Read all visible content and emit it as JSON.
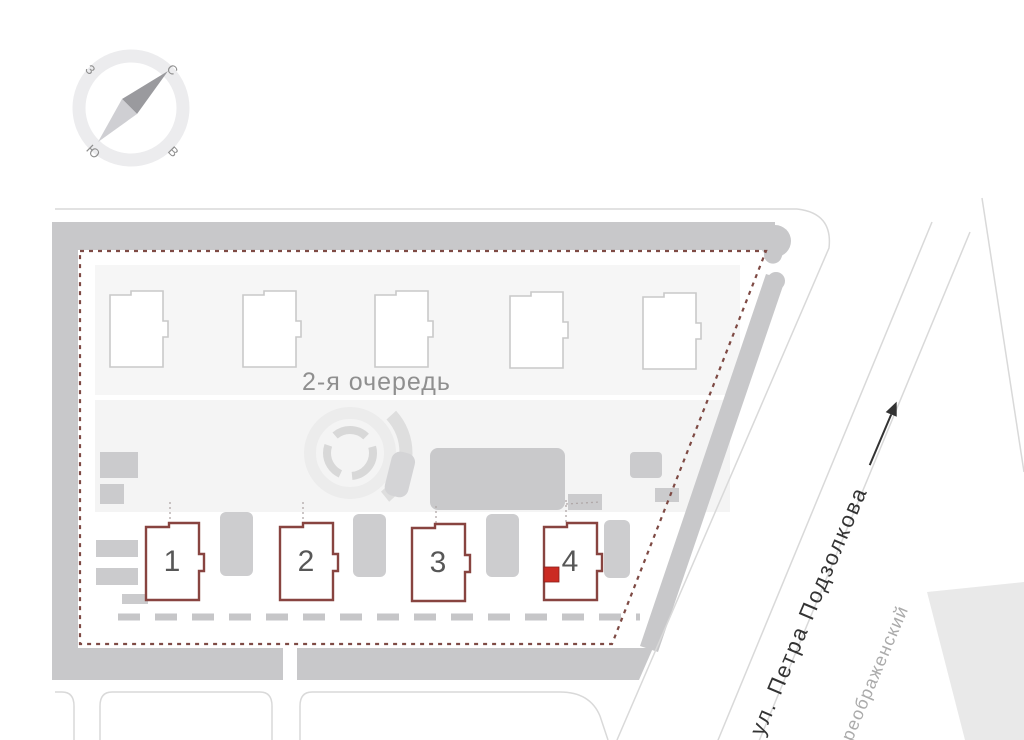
{
  "compass": {
    "north": "С",
    "east": "В",
    "south": "Ю",
    "west": "З"
  },
  "site": {
    "phase_label": "2-я очередь"
  },
  "buildings": [
    {
      "number": "1"
    },
    {
      "number": "2"
    },
    {
      "number": "3"
    },
    {
      "number": "4"
    }
  ],
  "streets": {
    "main_street": "ул. Петра Подзолкова",
    "district": "реображенский"
  },
  "colors": {
    "road": "#c8c8ca",
    "boundary_dashed": "#7e4a44",
    "building_outline": "#884440",
    "footprint_outline": "#c9c9c9",
    "selected_unit_marker": "#cb2b23",
    "label_gray": "#8f8f8f",
    "street_label": "#333333"
  }
}
